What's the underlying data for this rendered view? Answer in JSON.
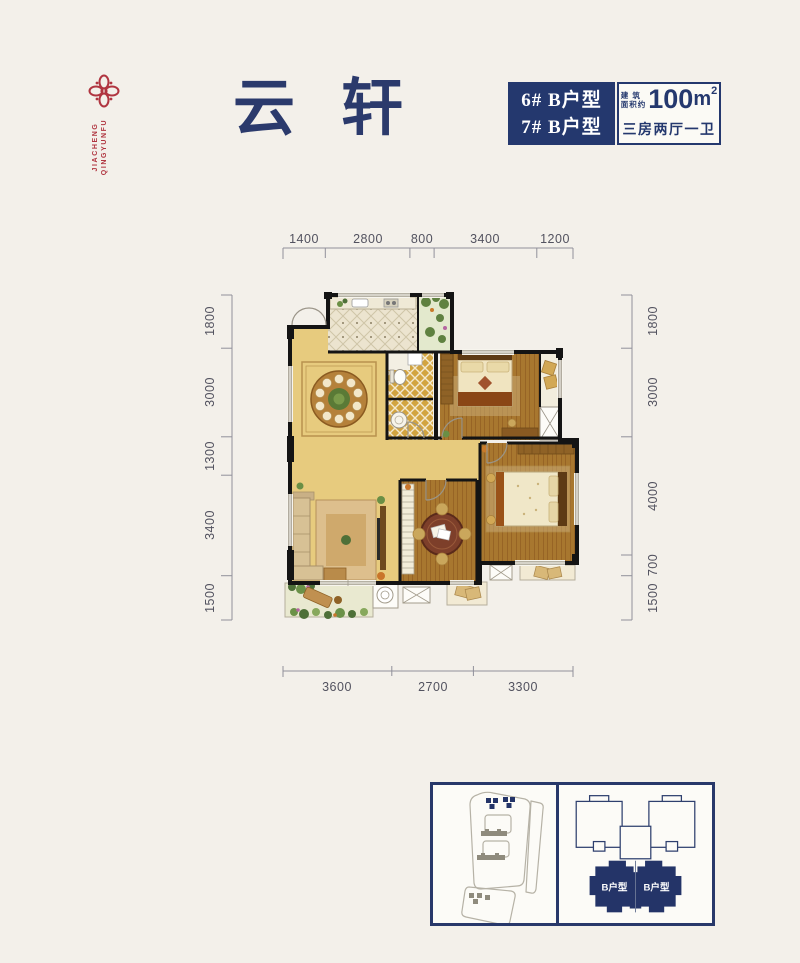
{
  "colors": {
    "navy": "#24386e",
    "brand_red": "#b03540",
    "page_bg": "#f3f0ea"
  },
  "header": {
    "logo": {
      "icon": "flower-icon",
      "line1": "JIACHENG",
      "line2": "QINGYUNFU"
    },
    "title": {
      "char1": "云",
      "char2": "轩"
    },
    "unit_box": {
      "line1": "6# B户型",
      "line2": "7# B户型"
    },
    "area_box": {
      "prefix_top": "建 筑",
      "prefix_bottom": "面积约",
      "value": "100",
      "unit": "m",
      "sup": "2",
      "layout": "三房两厅一卫"
    }
  },
  "dimensions": {
    "top": [
      "1400",
      "2800",
      "800",
      "3400",
      "1200"
    ],
    "bottom": [
      "3600",
      "2700",
      "3300"
    ],
    "left": [
      "1800",
      "3000",
      "1300",
      "3400",
      "1500"
    ],
    "right": [
      "1800",
      "3000",
      "4000",
      "700",
      "1500"
    ]
  },
  "keyplan": {
    "unit_left": "B户型",
    "unit_right": "B户型"
  }
}
